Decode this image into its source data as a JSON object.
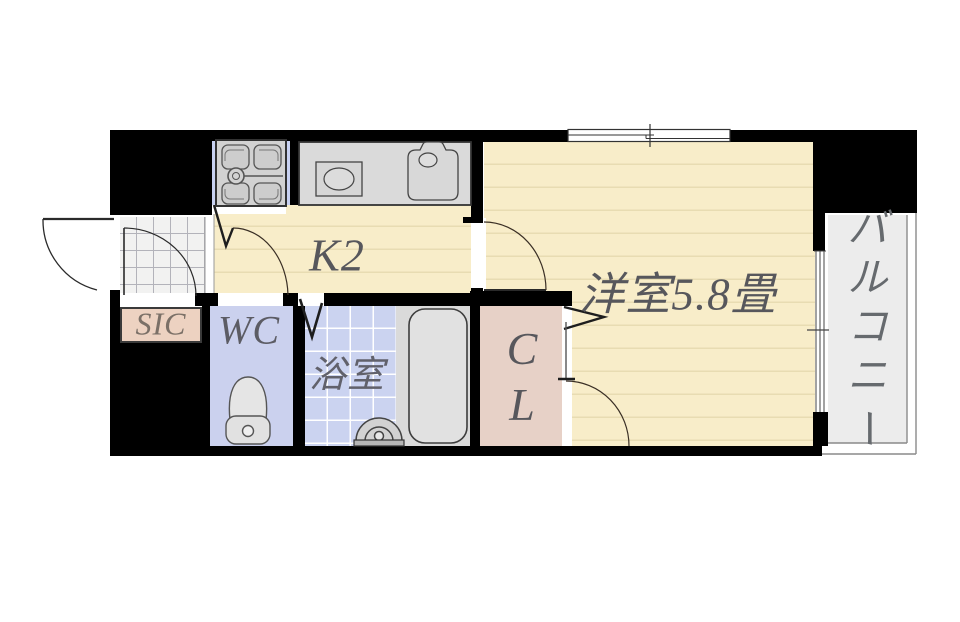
{
  "floorplan": {
    "title": "1K apartment floor plan",
    "rooms": {
      "kitchen": {
        "label": "K2"
      },
      "western_room": {
        "label": "洋室5.8畳"
      },
      "toilet": {
        "label": "WC"
      },
      "bathroom": {
        "label": "浴室"
      },
      "shoe_closet": {
        "label": "SIC"
      },
      "closet": {
        "label": "CL",
        "chars": [
          "C",
          "L"
        ]
      },
      "balcony": {
        "label": "バルコニー",
        "chars": [
          "バ",
          "ル",
          "コ",
          "ニ",
          "ー"
        ]
      }
    },
    "colors": {
      "wall": "#000000",
      "room_cream": "#f8edc9",
      "floor_line": "#e8dcb2",
      "wet_area_blue": "#cbd1ee",
      "bath_blue": "#cbd3f0",
      "closet_pink": "#e7d1c7",
      "sic_pink": "#edd2c1",
      "balcony_gray": "#ececec",
      "fixture_gray": "#d6d6d6",
      "label_gray": "#57575c"
    }
  }
}
